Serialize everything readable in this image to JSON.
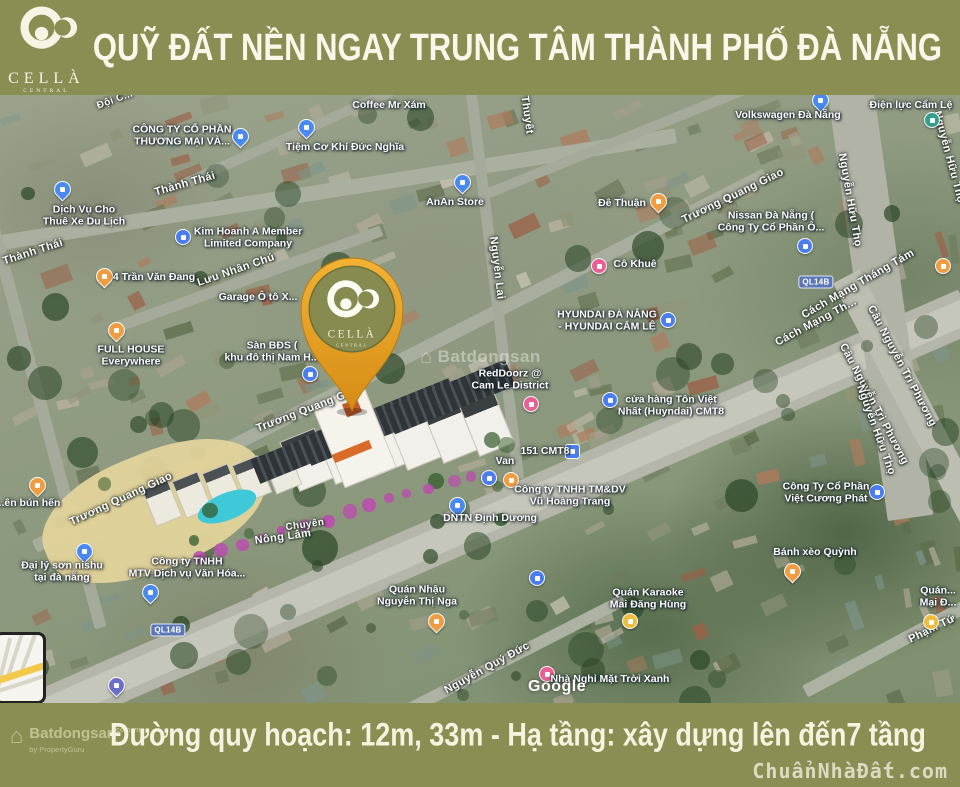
{
  "colors": {
    "band": "#8a8e52",
    "pin_orange": "#eea42d",
    "pin_inner": "#878b50",
    "pool": "#3fc8d8",
    "accent_magenta": "#b94fae"
  },
  "header": {
    "title": "QUỸ ĐẤT NỀN NGAY TRUNG TÂM THÀNH PHỐ ĐÀ NẴNG",
    "brand": {
      "name": "CELLÀ",
      "sub": "CENTRAL"
    }
  },
  "pin": {
    "brand": "CELLÀ",
    "sub": "CENTRAL"
  },
  "footer": {
    "text": "Đường quy hoạch: 12m, 33m - Hạ tầng: xây dựng lên đến7 tầng",
    "site": "ChuẩnNhàĐất.com",
    "watermark": {
      "name": "Batdongsan",
      "domain": "com.vn",
      "by": "by PropertyGuru"
    }
  },
  "map": {
    "attribution": "Google",
    "watermark": "Batdongsan",
    "road_shield_text": "QL14B",
    "road_shields": [
      {
        "x": 816,
        "y": 282
      },
      {
        "x": 168,
        "y": 630
      }
    ],
    "street_labels": [
      {
        "text": "Đội C...",
        "x": 115,
        "y": 100,
        "rot": -20,
        "size": 10
      },
      {
        "text": "Thuyết",
        "x": 527,
        "y": 115,
        "rot": 82
      },
      {
        "text": "Thành Thái",
        "x": 185,
        "y": 184,
        "rot": -16
      },
      {
        "text": "Thành Thái",
        "x": 33,
        "y": 252,
        "rot": -18
      },
      {
        "text": "Lưu Nhân Chú",
        "x": 236,
        "y": 270,
        "rot": -19
      },
      {
        "text": "Trương Quang Giao",
        "x": 733,
        "y": 196,
        "rot": -26
      },
      {
        "text": "Trương Quang Giao",
        "x": 121,
        "y": 499,
        "rot": -25
      },
      {
        "text": "Trương Quang G",
        "x": 301,
        "y": 412,
        "rot": -21
      },
      {
        "text": "Nguyễn Lai",
        "x": 497,
        "y": 268,
        "rot": 83
      },
      {
        "text": "Nguyễn Quý Đức",
        "x": 487,
        "y": 668,
        "rot": -29
      },
      {
        "text": "Phạm Tứ",
        "x": 932,
        "y": 629,
        "rot": -26
      },
      {
        "text": "Cách Mạng Tháng Tám",
        "x": 858,
        "y": 284,
        "rot": -30
      },
      {
        "text": "Cách Mạng Th...",
        "x": 816,
        "y": 322,
        "rot": -28
      },
      {
        "text": "Cầu Nguyễn Tri Phương",
        "x": 902,
        "y": 366,
        "rot": 62
      },
      {
        "text": "Cầu Nguyễn Tri Phương",
        "x": 874,
        "y": 404,
        "rot": 62
      },
      {
        "text": "Nguyễn Hữu Thọ",
        "x": 850,
        "y": 200,
        "rot": 80
      },
      {
        "text": "Nguyễn Hữu Thọ",
        "x": 949,
        "y": 157,
        "rot": 75
      },
      {
        "text": "Nguyễn Hữu Thọ",
        "x": 876,
        "y": 430,
        "rot": 70
      },
      {
        "text": "Chuyên",
        "x": 305,
        "y": 525,
        "rot": -8,
        "size": 10
      },
      {
        "text": "Nông Lâm",
        "x": 283,
        "y": 537,
        "rot": -8
      }
    ],
    "place_labels": [
      {
        "lines": [
          "CÔNG TY CỔ PHẦN",
          "THƯƠNG MẠI VÀ..."
        ],
        "x": 182,
        "y": 136
      },
      {
        "lines": [
          "Tiệm Cơ Khí Đức Nghĩa"
        ],
        "x": 345,
        "y": 148
      },
      {
        "lines": [
          "Coffee Mr Xám"
        ],
        "x": 389,
        "y": 106
      },
      {
        "lines": [
          "AnAn Store"
        ],
        "x": 455,
        "y": 203
      },
      {
        "lines": [
          "Dịch Vụ Cho",
          "Thuê Xe Du Lịch"
        ],
        "x": 84,
        "y": 216
      },
      {
        "lines": [
          "Kim Hoanh A Member",
          "Limited Company"
        ],
        "x": 248,
        "y": 238
      },
      {
        "lines": [
          "4 Trần Văn Đang"
        ],
        "x": 154,
        "y": 278
      },
      {
        "lines": [
          "Garage Ô tô X..."
        ],
        "x": 258,
        "y": 298
      },
      {
        "lines": [
          "FULL HOUSE",
          "Everywhere"
        ],
        "x": 131,
        "y": 356
      },
      {
        "lines": [
          "Sàn BĐS (",
          "khu đô thị Nam H..."
        ],
        "x": 272,
        "y": 352
      },
      {
        "lines": [
          "Đê Thuận"
        ],
        "x": 622,
        "y": 204
      },
      {
        "lines": [
          "Cô Khuê"
        ],
        "x": 635,
        "y": 265
      },
      {
        "lines": [
          "Volkswagen Đà Nẵng"
        ],
        "x": 788,
        "y": 116
      },
      {
        "lines": [
          "Điện lực Cẩm Lệ"
        ],
        "x": 911,
        "y": 106
      },
      {
        "lines": [
          "Nissan Đà Nẵng (",
          "Công Ty Cổ Phần Ô..."
        ],
        "x": 771,
        "y": 222
      },
      {
        "lines": [
          "HYUNDAI ĐÀ NẴNG",
          "- HYUNDAI CẨM LỆ"
        ],
        "x": 607,
        "y": 321
      },
      {
        "lines": [
          "cửa hàng Tôn Việt",
          "Nhất (Huyndai) CMT8"
        ],
        "x": 671,
        "y": 406
      },
      {
        "lines": [
          "RedDoorz @",
          "Cam Le District"
        ],
        "x": 510,
        "y": 380
      },
      {
        "lines": [
          "151 CMT8"
        ],
        "x": 545,
        "y": 452
      },
      {
        "lines": [
          "Van"
        ],
        "x": 505,
        "y": 462
      },
      {
        "lines": [
          "Công ty TNHH TM&DV",
          "Vũ Hoàng Trang"
        ],
        "x": 570,
        "y": 496
      },
      {
        "lines": [
          "DNTN Định Dương"
        ],
        "x": 490,
        "y": 519
      },
      {
        "lines": [
          "Đại lý sơn nishu",
          "tại đà nẵng"
        ],
        "x": 62,
        "y": 572
      },
      {
        "lines": [
          "Công ty TNHH",
          "MTV Dịch vụ Văn Hóa..."
        ],
        "x": 187,
        "y": 568
      },
      {
        "lines": [
          "Quán Nhậu",
          "Nguyễn Thị Nga"
        ],
        "x": 417,
        "y": 596
      },
      {
        "lines": [
          "Quán Karaoke",
          "Mai Đăng Hùng"
        ],
        "x": 648,
        "y": 599
      },
      {
        "lines": [
          "Nhà Nghỉ Mặt Trời Xanh"
        ],
        "x": 610,
        "y": 680
      },
      {
        "lines": [
          "Bánh xèo Quỳnh"
        ],
        "x": 815,
        "y": 553
      },
      {
        "lines": [
          "Công Ty Cổ Phần",
          "Việt Cương Phát"
        ],
        "x": 826,
        "y": 493
      },
      {
        "lines": [
          "...ên bún hến"
        ],
        "x": 28,
        "y": 504
      },
      {
        "lines": [
          "Quán...",
          "Mại Đ..."
        ],
        "x": 938,
        "y": 597
      }
    ],
    "icons": [
      {
        "type": "pin-blue",
        "x": 240,
        "y": 136
      },
      {
        "type": "pin-blue",
        "x": 306,
        "y": 127
      },
      {
        "type": "pin-blue",
        "x": 62,
        "y": 189
      },
      {
        "type": "biz-blue",
        "x": 183,
        "y": 237
      },
      {
        "type": "pin-blue",
        "x": 462,
        "y": 182
      },
      {
        "type": "food-orange",
        "x": 104,
        "y": 276
      },
      {
        "type": "food-orange",
        "x": 116,
        "y": 330
      },
      {
        "type": "food-orange",
        "x": 658,
        "y": 201
      },
      {
        "type": "lodging-pink",
        "x": 599,
        "y": 266
      },
      {
        "type": "pin-blue",
        "x": 820,
        "y": 100
      },
      {
        "type": "power-teal",
        "x": 932,
        "y": 120
      },
      {
        "type": "biz-blue",
        "x": 805,
        "y": 246
      },
      {
        "type": "biz-blue",
        "x": 668,
        "y": 320
      },
      {
        "type": "biz-blue",
        "x": 610,
        "y": 400
      },
      {
        "type": "lodging-pink",
        "x": 531,
        "y": 404
      },
      {
        "type": "sq-blue",
        "x": 573,
        "y": 452
      },
      {
        "type": "biz-blue",
        "x": 489,
        "y": 478
      },
      {
        "type": "food-circle",
        "x": 511,
        "y": 480
      },
      {
        "type": "pin-blue",
        "x": 457,
        "y": 505
      },
      {
        "type": "biz-blue",
        "x": 537,
        "y": 578
      },
      {
        "type": "pin-blue",
        "x": 84,
        "y": 551
      },
      {
        "type": "pin-blue",
        "x": 150,
        "y": 592
      },
      {
        "type": "food-orange",
        "x": 436,
        "y": 621
      },
      {
        "type": "bar-yellow",
        "x": 630,
        "y": 621
      },
      {
        "type": "lodging-pink",
        "x": 547,
        "y": 674
      },
      {
        "type": "food-orange",
        "x": 792,
        "y": 571
      },
      {
        "type": "biz-blue",
        "x": 877,
        "y": 492
      },
      {
        "type": "food-orange",
        "x": 37,
        "y": 485
      },
      {
        "type": "bar-yellow",
        "x": 931,
        "y": 622
      },
      {
        "type": "food-circle",
        "x": 943,
        "y": 266
      },
      {
        "type": "gas-blue",
        "x": 116,
        "y": 685
      },
      {
        "type": "biz-blue",
        "x": 310,
        "y": 374
      }
    ]
  }
}
